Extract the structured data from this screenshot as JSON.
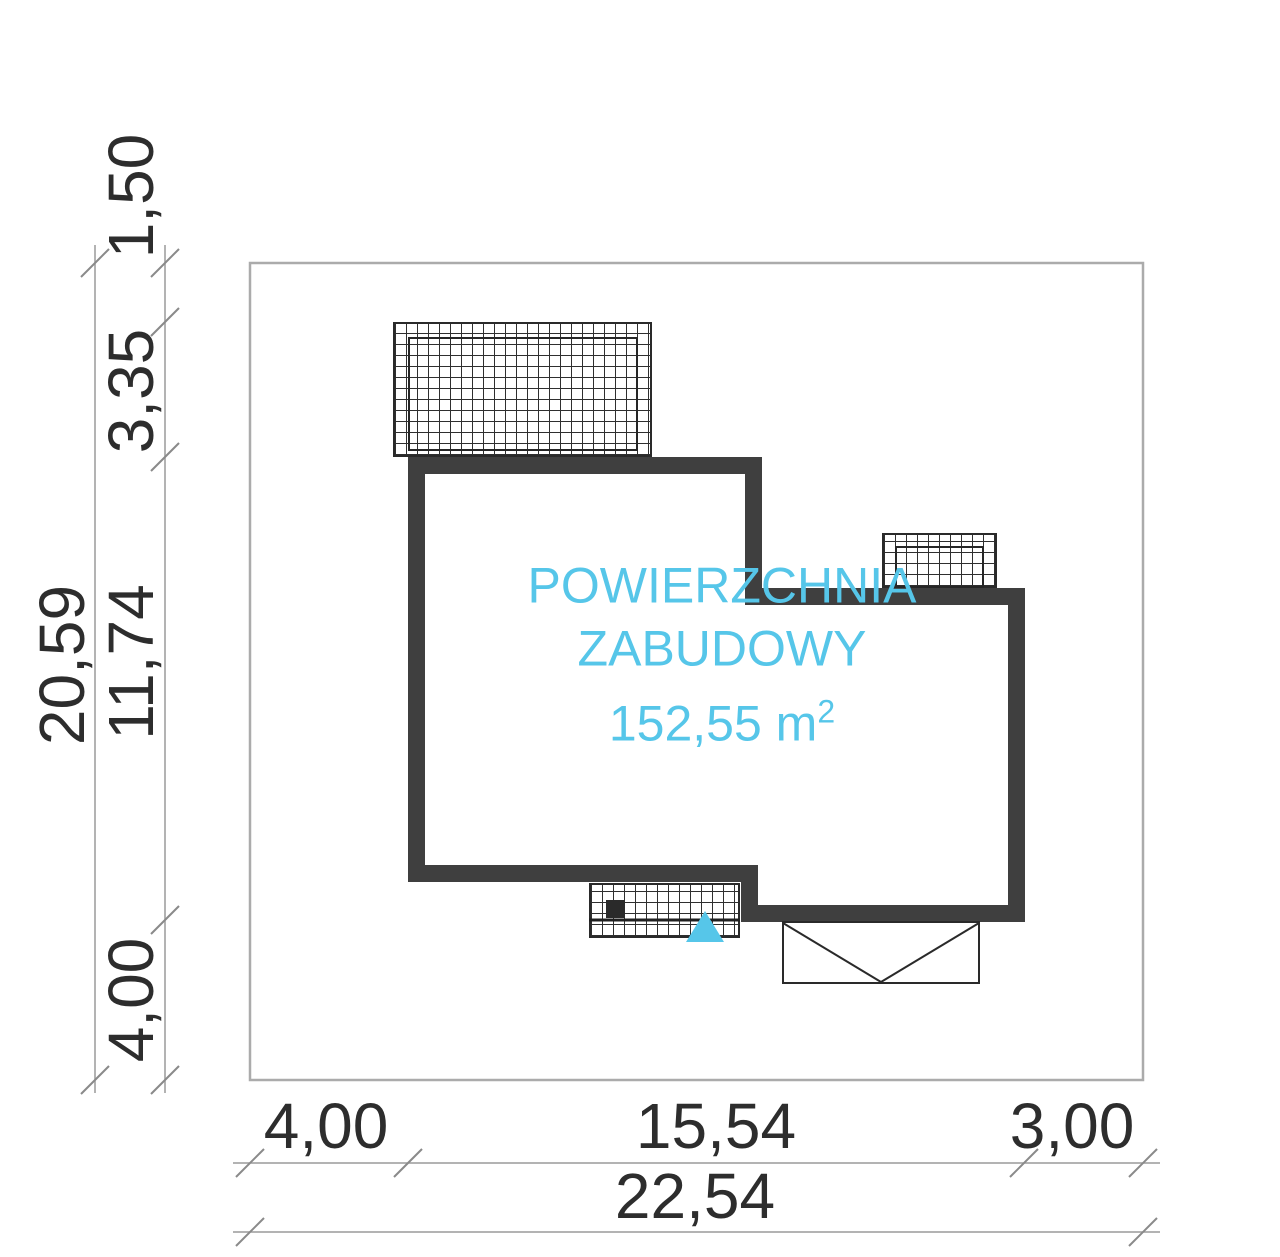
{
  "plan": {
    "area_label": {
      "line1": "POWIERZCHNIA",
      "line2": "ZABUDOWY",
      "value": "152,55 m",
      "sup": "2"
    },
    "colors": {
      "accent_cyan": "#56c6e9",
      "wall_gray": "#3f3f3f",
      "dim_text": "#2d2d2d",
      "plot_border": "#ababab"
    }
  },
  "dimensions": {
    "left_overall": "20,59",
    "left_segments": [
      "1,50",
      "3,35",
      "11,74",
      "4,00"
    ],
    "bottom_segments": [
      "4,00",
      "15,54",
      "3,00"
    ],
    "bottom_overall": "22,54"
  }
}
